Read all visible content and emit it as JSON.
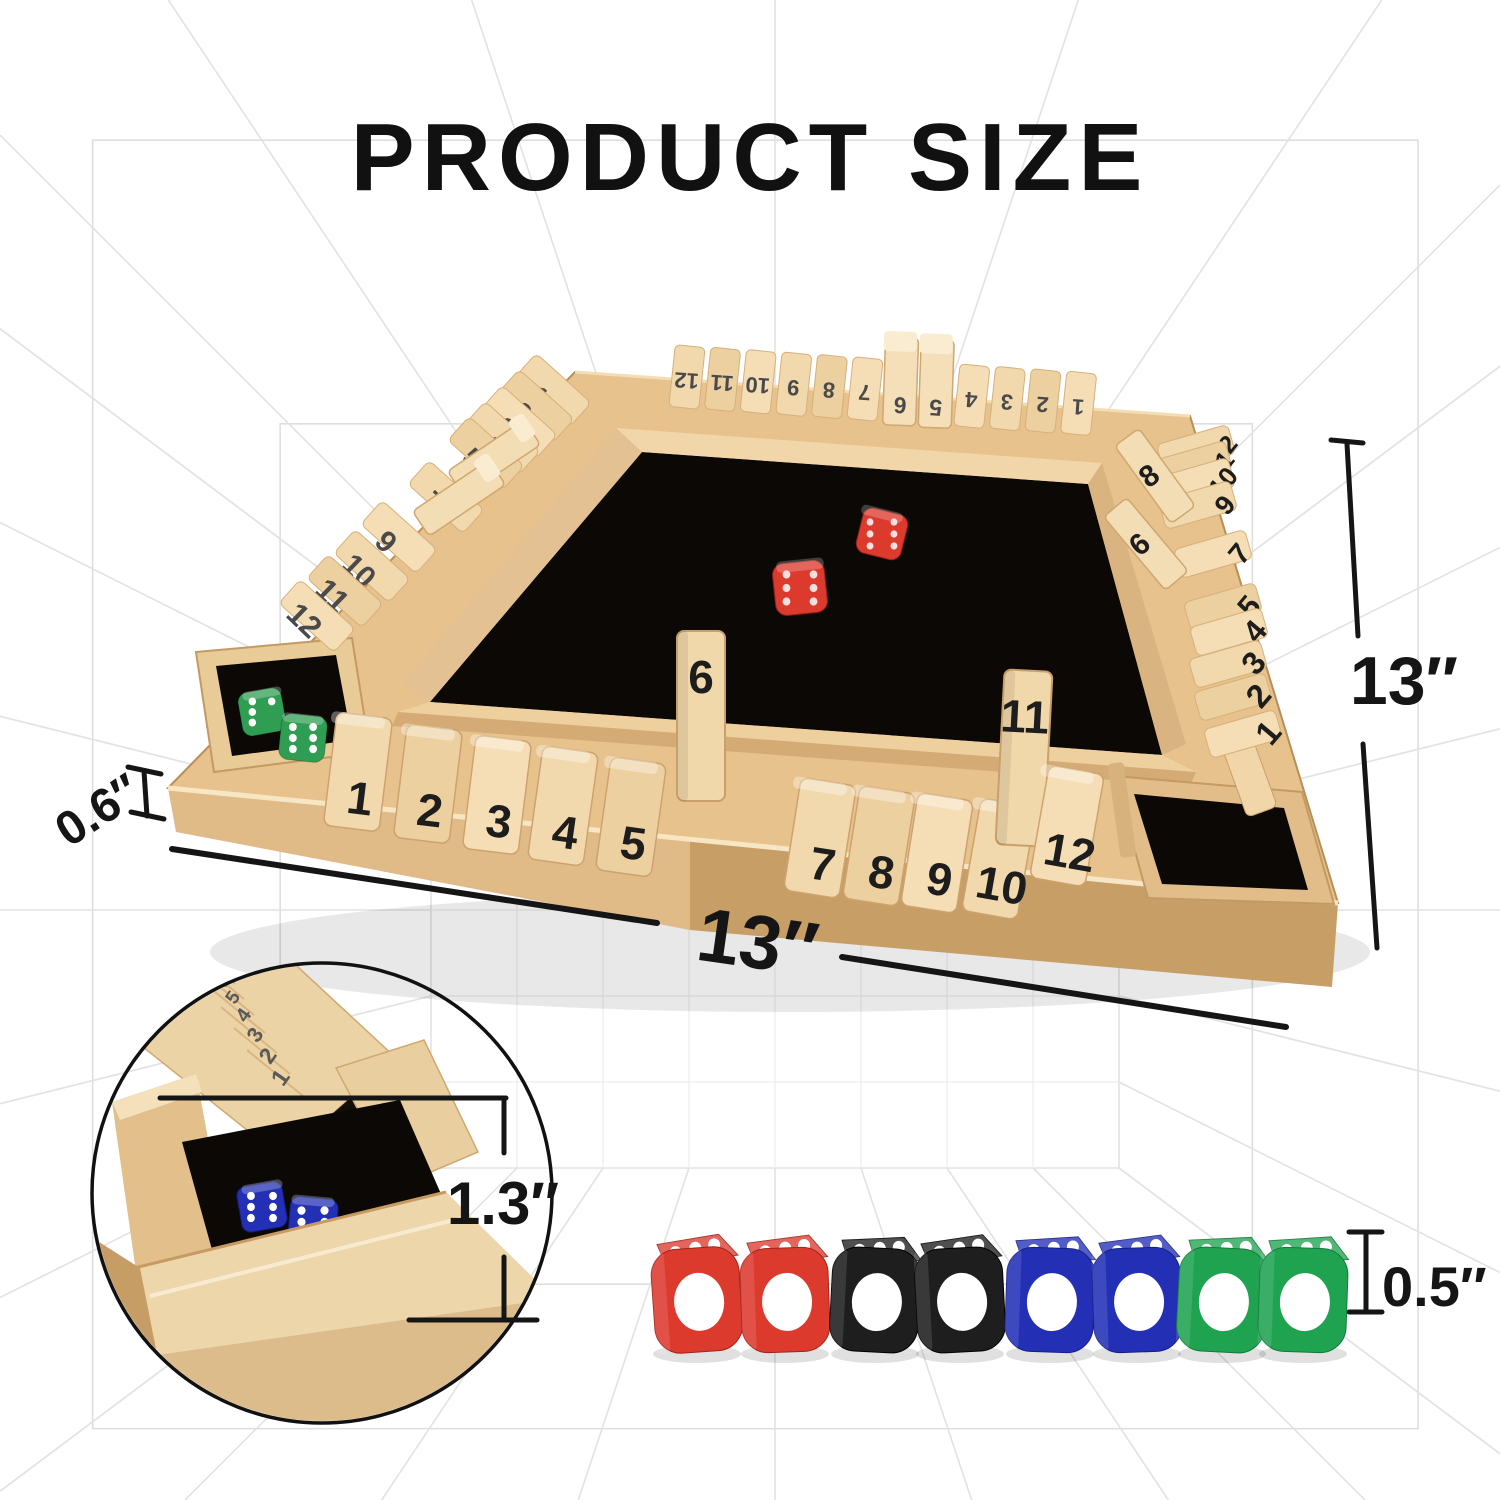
{
  "title": "PRODUCT SIZE",
  "annotations": {
    "width": "13″",
    "depth": "13″",
    "thickness": "0.6″",
    "rail_height": "1.3″",
    "die_size": "0.5″"
  },
  "board": {
    "far_rail": {
      "tiles": [
        "12",
        "11",
        "10",
        "9",
        "8",
        "7",
        "6",
        "5",
        "4",
        "3",
        "2",
        "1"
      ],
      "raised": [
        "6",
        "5"
      ]
    },
    "left_rail": {
      "tiles": [
        "1",
        "2",
        "3",
        "4",
        "5",
        "6",
        "7",
        "8",
        "9",
        "10",
        "11",
        "12"
      ],
      "raised": [
        "6",
        "8"
      ]
    },
    "right_rail": {
      "tiles": [
        "12",
        "11",
        "10",
        "9",
        "8",
        "7",
        "6",
        "5",
        "4",
        "3",
        "2",
        "1"
      ],
      "raised": [
        "8",
        "6"
      ]
    },
    "front_rail": {
      "tiles": [
        "1",
        "2",
        "3",
        "4",
        "5",
        "6",
        "7",
        "8",
        "9",
        "10",
        "11",
        "12"
      ],
      "raised": [
        "6",
        "11"
      ]
    },
    "center_dice": [
      "red",
      "red"
    ],
    "corner_tray_dice": [
      "green",
      "green"
    ]
  },
  "inset": {
    "tile_numbers": [
      "1",
      "2",
      "3",
      "4",
      "5",
      "6",
      "7"
    ],
    "dice": [
      "blue",
      "blue"
    ]
  },
  "dice_row": {
    "dice": [
      {
        "color": "red",
        "front_pips": 1,
        "top_pips": 3
      },
      {
        "color": "red",
        "front_pips": 1,
        "top_pips": 3
      },
      {
        "color": "black",
        "front_pips": 1,
        "top_pips": 3
      },
      {
        "color": "black",
        "front_pips": 1,
        "top_pips": 3
      },
      {
        "color": "blue",
        "front_pips": 1,
        "top_pips": 3
      },
      {
        "color": "blue",
        "front_pips": 1,
        "top_pips": 3
      },
      {
        "color": "green",
        "front_pips": 1,
        "top_pips": 3
      },
      {
        "color": "green",
        "front_pips": 1,
        "top_pips": 3
      }
    ]
  },
  "colors": {
    "wood_light": "#f2d9ad",
    "wood_mid": "#e6c491",
    "wood_dark": "#cda26d",
    "wood_deep": "#b08350",
    "felt": "#0b0806",
    "number_dark": "#1d1d1d",
    "number_gray": "#4a4a4a",
    "line": "#151515",
    "grid": "#e2e2e2",
    "die_red": "#dd3a2e",
    "die_black": "#1f1e1f",
    "die_blue": "#2330b5",
    "die_green": "#1fa351",
    "pip": "#ffffff"
  }
}
